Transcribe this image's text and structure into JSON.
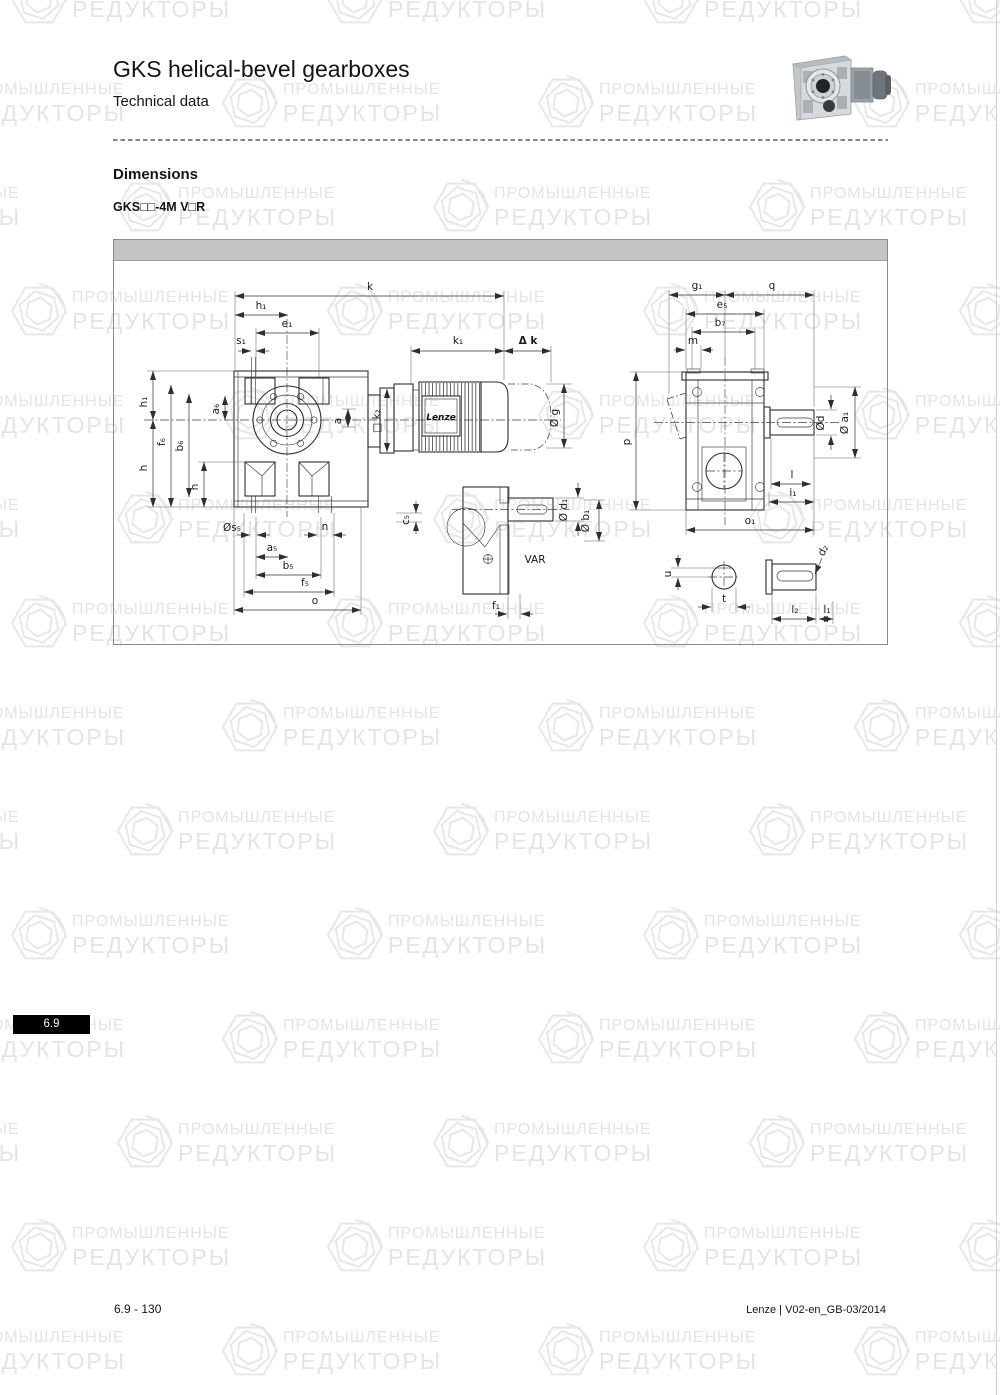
{
  "page": {
    "title": "GKS helical-bevel gearboxes",
    "subtitle": "Technical data",
    "section_heading": "Dimensions",
    "model_designation": "GKS□□-4M V□R",
    "tab_label": "6.9",
    "footer_left": "6.9 - 130",
    "footer_right": "Lenze | V02-en_GB-03/2014"
  },
  "watermark": {
    "line1": "ПРОМЫШЛЕННЫЕ",
    "line2": "РЕДУКТОРЫ"
  },
  "drawing": {
    "motor_brand": "Lenze",
    "variant_label": "VAR",
    "labels": {
      "k": "k",
      "h1_top": "h₁",
      "e1": "e₁",
      "s1": "s₁",
      "k1": "k₁",
      "dk": "Δ k",
      "k2": "□ k₂",
      "g": "Ø g",
      "h1_side": "h₁",
      "h": "h",
      "f6": "f₆",
      "b6": "b₆",
      "a6": "a₆",
      "n_left": "n",
      "a": "a",
      "s5": "Øs₅",
      "n_bottom": "n",
      "a5": "a₅",
      "b5": "b₅",
      "f5": "f₅",
      "o": "o",
      "c5": "c₅",
      "d1": "Ø d₁",
      "b1": "Ø b₁",
      "f1": "f₁",
      "g1": "g₁",
      "q": "q",
      "e5": "e₅",
      "b7": "b₇",
      "m": "m",
      "p": "p",
      "d": "Ød",
      "a1": "Ø a₁",
      "l": "l",
      "i1": "i₁",
      "o1": "o₁",
      "u": "u",
      "t": "t",
      "d2": "d₂",
      "l2": "l₂",
      "l1": "l₁"
    }
  }
}
